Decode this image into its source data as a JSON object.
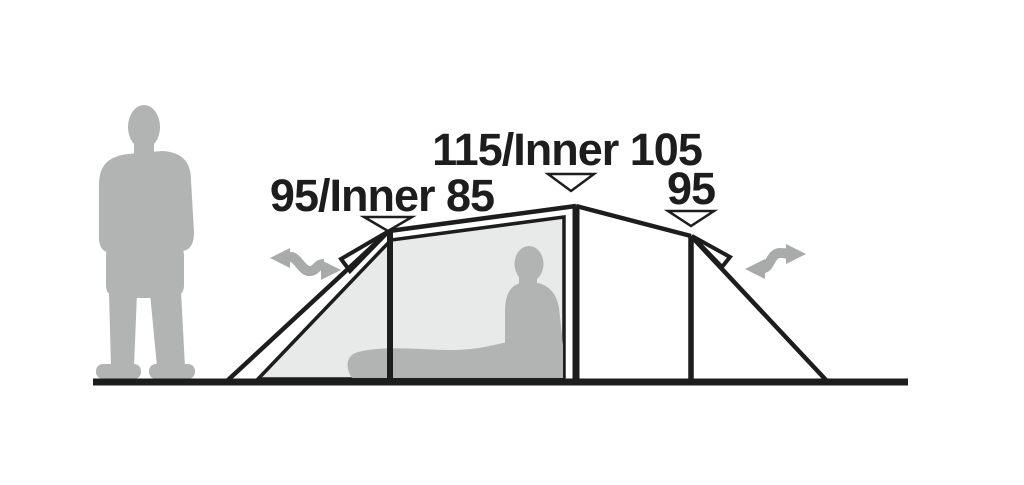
{
  "diagram": {
    "type": "tent-side-profile-dimension-diagram",
    "measurements": {
      "left": {
        "label": "95/Inner 85",
        "outer": 95,
        "inner": 85
      },
      "center": {
        "label": "115/Inner 105",
        "outer": 115,
        "inner": 105
      },
      "right": {
        "label": "95",
        "outer": 95
      }
    },
    "colors": {
      "background": "#ffffff",
      "line": "#1d1d1d",
      "silhouette_gray": "#b2b3b3",
      "inner_tent_gray": "#e8e9e9",
      "arrow_gray": "#a9abab"
    },
    "icons": {
      "left_entrance": "double-headed-wavy-arrow",
      "right_entrance": "double-headed-wavy-arrow",
      "pointer_markers": "downward-triangle-pointer"
    },
    "figures": {
      "scale_figure": "standing-adult-silhouette",
      "occupant_figure": "seated-person-with-sleeping-mat"
    }
  }
}
